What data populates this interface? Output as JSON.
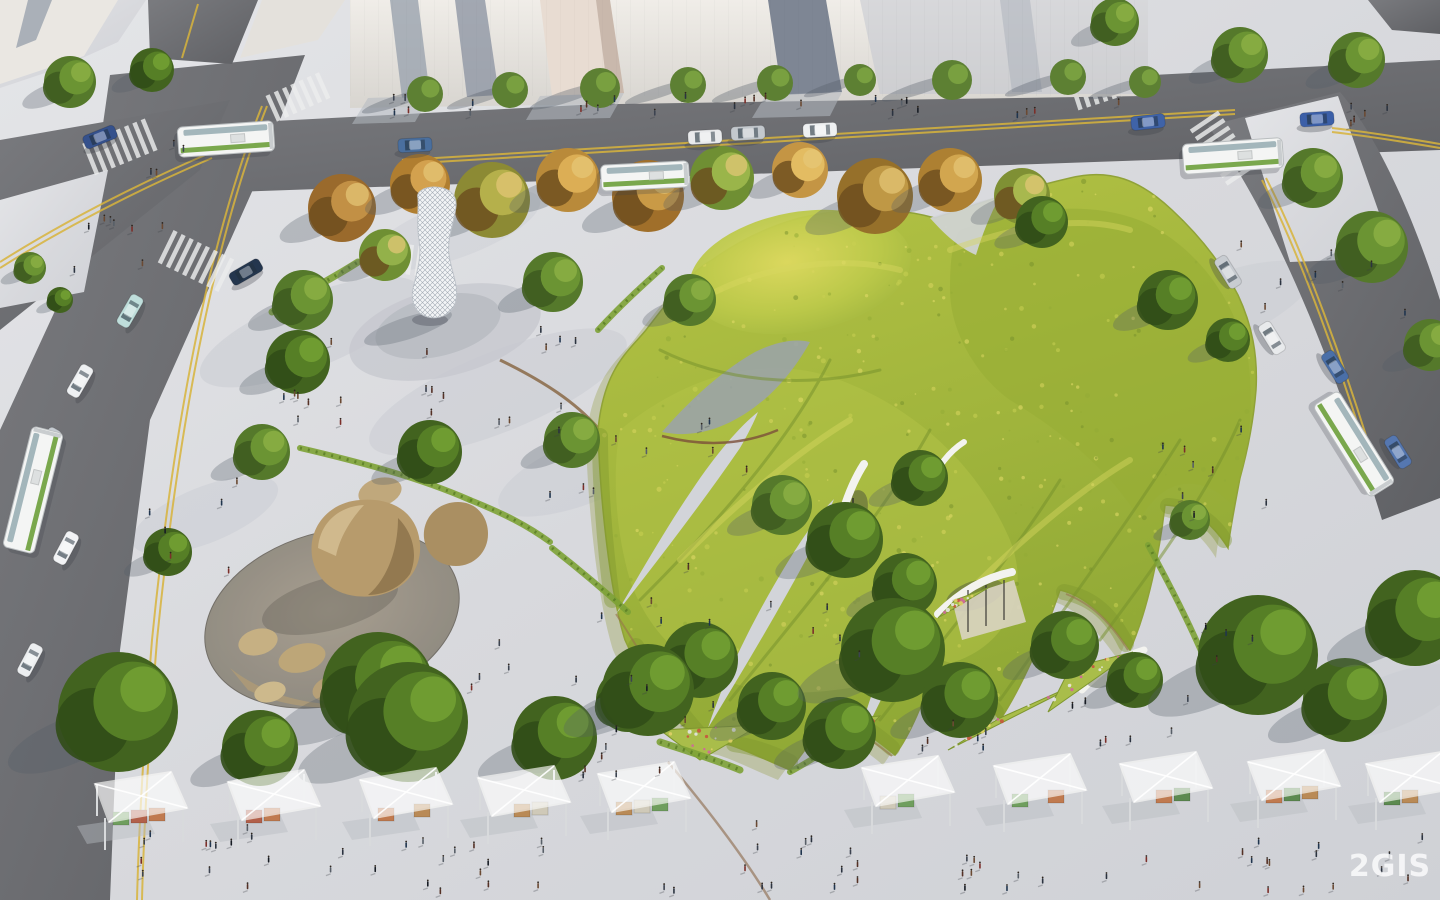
{
  "watermark": {
    "text": "2GIS"
  },
  "palette": {
    "plaza": "#d8d9dd",
    "asphalt": "#6b6c70",
    "meadow": "#aec23d",
    "meadow_light": "#d8d65e",
    "meadow_dark": "#7e962e",
    "yellow_line": "#d8b43c",
    "shadow": "#525c66",
    "crates": [
      "#6f9e5e",
      "#b2604a",
      "#c07a4f",
      "#5c8a50",
      "#b98a56",
      "#cfc9b8"
    ],
    "flower_dots": [
      "#d263a0",
      "#e8e8ea",
      "#c8503c",
      "#e3d168"
    ],
    "people_colors": [
      "#171c24",
      "#2b3340",
      "#3c4350",
      "#553126",
      "#6b4a33",
      "#20354e",
      "#585f68",
      "#7c2f2a"
    ]
  },
  "scene": {
    "trees_green": [
      [
        70,
        82,
        26,
        0
      ],
      [
        152,
        70,
        22,
        1
      ],
      [
        30,
        268,
        16,
        0
      ],
      [
        60,
        300,
        13,
        1
      ],
      [
        303,
        300,
        30,
        0
      ],
      [
        298,
        362,
        32,
        1
      ],
      [
        262,
        452,
        28,
        0
      ],
      [
        553,
        282,
        30,
        0
      ],
      [
        430,
        452,
        32,
        1
      ],
      [
        572,
        440,
        28,
        0
      ],
      [
        690,
        300,
        26,
        0
      ],
      [
        168,
        552,
        24,
        1
      ],
      [
        378,
        688,
        56,
        1
      ],
      [
        1042,
        222,
        26,
        1
      ],
      [
        1168,
        300,
        30,
        1
      ],
      [
        1228,
        340,
        22,
        1
      ],
      [
        920,
        478,
        28,
        1
      ],
      [
        845,
        540,
        38,
        1
      ],
      [
        782,
        505,
        30,
        0
      ],
      [
        905,
        585,
        32,
        1
      ],
      [
        1065,
        645,
        34,
        1
      ],
      [
        1135,
        680,
        28,
        1
      ],
      [
        700,
        660,
        38,
        1
      ],
      [
        772,
        706,
        34,
        1
      ],
      [
        840,
        733,
        36,
        1
      ],
      [
        628,
        700,
        32,
        1
      ],
      [
        118,
        712,
        60,
        1
      ],
      [
        260,
        748,
        38,
        1
      ],
      [
        408,
        722,
        60,
        1
      ],
      [
        555,
        738,
        42,
        1
      ],
      [
        648,
        690,
        46,
        1
      ],
      [
        893,
        650,
        52,
        1
      ],
      [
        960,
        700,
        38,
        1
      ],
      [
        1258,
        655,
        60,
        1
      ],
      [
        1345,
        700,
        42,
        1
      ],
      [
        1415,
        618,
        48,
        1
      ],
      [
        1313,
        178,
        30,
        0
      ],
      [
        1372,
        247,
        36,
        0
      ],
      [
        1430,
        345,
        26,
        0
      ],
      [
        1240,
        55,
        28,
        0
      ],
      [
        1357,
        60,
        28,
        0
      ],
      [
        1115,
        22,
        24,
        0
      ],
      [
        1190,
        520,
        20,
        0
      ]
    ],
    "trees_autumn": [
      [
        342,
        208,
        34,
        "#9a6a2c",
        "#c29045"
      ],
      [
        420,
        184,
        30,
        "#b07e30",
        "#d3a14e"
      ],
      [
        492,
        200,
        38,
        "#8c8a34",
        "#b5b04b"
      ],
      [
        568,
        180,
        32,
        "#b98a3a",
        "#dcae55"
      ],
      [
        648,
        196,
        36,
        "#a06f2a",
        "#c99a46"
      ],
      [
        722,
        178,
        32,
        "#6f8f33",
        "#9ab54a"
      ],
      [
        800,
        170,
        28,
        "#c49544",
        "#e3bc62"
      ],
      [
        875,
        196,
        38,
        "#96702a",
        "#bf9845"
      ],
      [
        950,
        180,
        32,
        "#ad8032",
        "#d2a64f"
      ],
      [
        1022,
        196,
        28,
        "#7f9034",
        "#a8b84e"
      ],
      [
        385,
        255,
        26,
        "#6f8f33",
        "#93b14a"
      ]
    ],
    "trees_sidewalk": [
      [
        425,
        94,
        18
      ],
      [
        510,
        90,
        18
      ],
      [
        600,
        88,
        20
      ],
      [
        688,
        85,
        18
      ],
      [
        775,
        83,
        18
      ],
      [
        860,
        80,
        16
      ],
      [
        952,
        80,
        20
      ],
      [
        1068,
        77,
        18
      ],
      [
        1145,
        82,
        16
      ]
    ],
    "stalls": [
      [
        95,
        772
      ],
      [
        228,
        770
      ],
      [
        360,
        768
      ],
      [
        478,
        766
      ],
      [
        598,
        762
      ],
      [
        862,
        756
      ],
      [
        994,
        754
      ],
      [
        1120,
        752
      ],
      [
        1248,
        750
      ],
      [
        1366,
        752
      ]
    ],
    "cars": [
      [
        415,
        145,
        -3,
        "#4a6f9e"
      ],
      [
        705,
        137,
        -3,
        "#e9eaec"
      ],
      [
        748,
        133,
        -3,
        "#c3c8cd"
      ],
      [
        820,
        130,
        -3,
        "#eef0f1"
      ],
      [
        1148,
        122,
        -6,
        "#3f63a8"
      ],
      [
        1317,
        119,
        -4,
        "#3b5fa8"
      ],
      [
        1228,
        272,
        58,
        "#c8ccd1"
      ],
      [
        1272,
        338,
        58,
        "#e8eaec"
      ],
      [
        1335,
        367,
        58,
        "#4a6fa8"
      ],
      [
        1398,
        452,
        58,
        "#5577b0"
      ],
      [
        100,
        137,
        -22,
        "#35518c"
      ],
      [
        246,
        272,
        -30,
        "#24364e"
      ],
      [
        130,
        311,
        -60,
        "#bfdedb"
      ],
      [
        80,
        381,
        -60,
        "#eef0f2"
      ],
      [
        48,
        444,
        -60,
        "#c6cbd1"
      ],
      [
        66,
        548,
        -62,
        "#f2f3f5"
      ],
      [
        30,
        660,
        -62,
        "#eceef0"
      ]
    ],
    "buses": [
      [
        226,
        139,
        -4,
        96,
        30
      ],
      [
        645,
        176,
        -3,
        88,
        26
      ],
      [
        1233,
        156,
        -4,
        100,
        30
      ],
      [
        1354,
        444,
        58,
        108,
        30
      ],
      [
        33,
        490,
        -76,
        124,
        32
      ]
    ],
    "crosswalks": [
      [
        122,
        146,
        -22,
        8,
        34
      ],
      [
        300,
        96,
        -24,
        7,
        28
      ],
      [
        198,
        262,
        26,
        8,
        36
      ],
      [
        412,
        260,
        8,
        9,
        30
      ],
      [
        1108,
        85,
        -18,
        8,
        30
      ],
      [
        1224,
        150,
        56,
        8,
        34
      ]
    ],
    "grass_strips": [
      {
        "d": "M272,312 C300,295 330,280 358,262",
        "w": 7
      },
      {
        "d": "M598,330 C620,306 642,286 662,268",
        "w": 6
      },
      {
        "d": "M300,448 C360,462 420,478 470,500",
        "w": 6
      },
      {
        "d": "M470,500 C505,514 528,526 550,542",
        "w": 6
      },
      {
        "d": "M552,548 C580,570 606,592 628,612",
        "w": 6
      },
      {
        "d": "M1148,545 C1170,585 1190,625 1205,660",
        "w": 6
      },
      {
        "d": "M660,742 C690,752 716,760 740,770",
        "w": 7
      },
      {
        "d": "M790,772 C812,760 830,748 846,738",
        "w": 6
      }
    ],
    "flower_patches": [
      {
        "pts": [
          [
            948,
            750
          ],
          [
            1090,
            678
          ],
          [
            1000,
            718
          ]
        ]
      },
      {
        "pts": [
          [
            1048,
            712
          ],
          [
            1133,
            652
          ],
          [
            1070,
            668
          ]
        ]
      },
      {
        "pts": [
          [
            938,
            618
          ],
          [
            988,
            588
          ],
          [
            955,
            600
          ]
        ]
      },
      {
        "pts": [
          [
            660,
            730
          ],
          [
            760,
            725
          ],
          [
            700,
            760
          ]
        ]
      },
      {
        "pts": [
          [
            812,
            722
          ],
          [
            880,
            716
          ],
          [
            836,
            762
          ]
        ]
      }
    ],
    "people_clusters": [
      [
        390,
        96,
        730,
        20,
        26
      ],
      [
        60,
        196,
        110,
        90,
        8
      ],
      [
        230,
        325,
        150,
        100,
        8
      ],
      [
        415,
        330,
        190,
        110,
        12
      ],
      [
        535,
        425,
        130,
        90,
        6
      ],
      [
        600,
        556,
        120,
        80,
        5
      ],
      [
        145,
        478,
        105,
        120,
        6
      ],
      [
        695,
        415,
        85,
        60,
        4
      ],
      [
        755,
        598,
        105,
        80,
        5
      ],
      [
        615,
        678,
        125,
        60,
        5
      ],
      [
        895,
        698,
        125,
        60,
        6
      ],
      [
        1040,
        695,
        150,
        70,
        7
      ],
      [
        1150,
        415,
        130,
        145,
        8
      ],
      [
        1235,
        235,
        170,
        85,
        8
      ],
      [
        85,
        825,
        270,
        62,
        15
      ],
      [
        375,
        840,
        310,
        52,
        16
      ],
      [
        690,
        815,
        170,
        80,
        13
      ],
      [
        940,
        835,
        330,
        58,
        18
      ],
      [
        1280,
        835,
        155,
        58,
        8
      ],
      [
        470,
        635,
        120,
        60,
        5
      ],
      [
        1320,
        105,
        110,
        42,
        5
      ],
      [
        112,
        135,
        85,
        40,
        4
      ],
      [
        540,
        740,
        130,
        40,
        6
      ],
      [
        1190,
        620,
        90,
        60,
        4
      ]
    ]
  }
}
